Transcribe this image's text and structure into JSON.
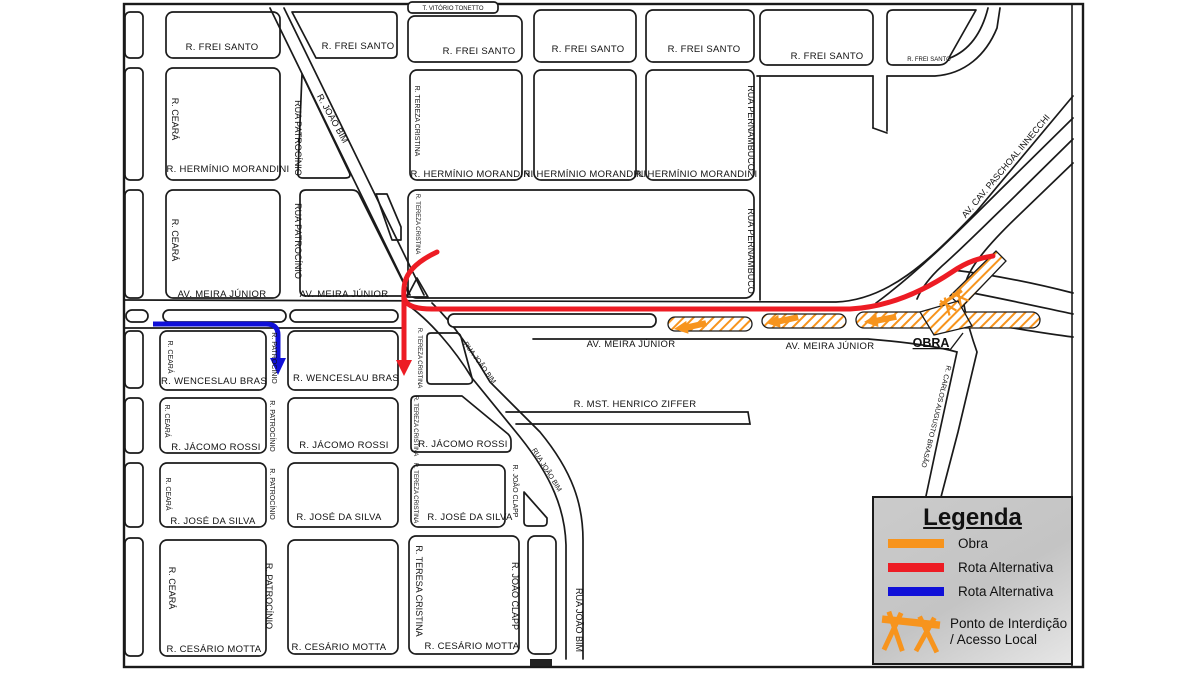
{
  "title": "Mapa de interdição de obra - rotas alternativas",
  "colors": {
    "obra_orange": "#F7941D",
    "rota_alternativa_red": "#ED1C24",
    "rota_alternativa_blue": "#1010D8",
    "road_line": "#1a1a1a",
    "legend_background": "#C8C8C8"
  },
  "streets": {
    "frei_santo": "R. FREI SANTO",
    "vitorio_tonetto": "T. VITÓRIO TONETTO",
    "herminio_morandini": "R. HERMÍNIO MORANDINI",
    "meira_junior": "AV. MEIRA JÚNIOR",
    "wenceslau_bras": "R. WENCESLAU BRAS",
    "jacomo_rossi": "R. JÁCOMO ROSSI",
    "jose_da_silva": "R. JOSÉ DA SILVA",
    "cesario_motta": "R. CESÁRIO MOTTA",
    "henrico_ziffer": "R. MST. HENRICO ZIFFER",
    "ceara": "R. CEARÁ",
    "rua_patrocinio": "RUA PATROCÍNIO",
    "patrocinio": "R. PATROCÍNIO",
    "joao_bim": "R. JOÃO BIM",
    "rua_joao_bim": "RUA JOÃO BIM",
    "tereza_cristina": "R. TEREZA CRISTINA",
    "teresa_cristina": "R. TERESA CRISTINA",
    "pernambuco": "RUA PERNAMBUCO",
    "joao_clapp": "R. JOÃO CLAPP",
    "paschoal_innecchi": "AV. CAV. PASCHOAL INNECCHI",
    "carlos_augusto_brasao": "R. CARLOS AUGUSTO BRASÃO"
  },
  "annotations": {
    "obra": "OBRA"
  },
  "legend": {
    "title": "Legenda",
    "items": [
      {
        "label": "Obra"
      },
      {
        "label": "Rota Alternativa"
      },
      {
        "label": "Rota Alternativa"
      },
      {
        "label": "Ponto de Interdição / Acesso Local"
      }
    ]
  }
}
